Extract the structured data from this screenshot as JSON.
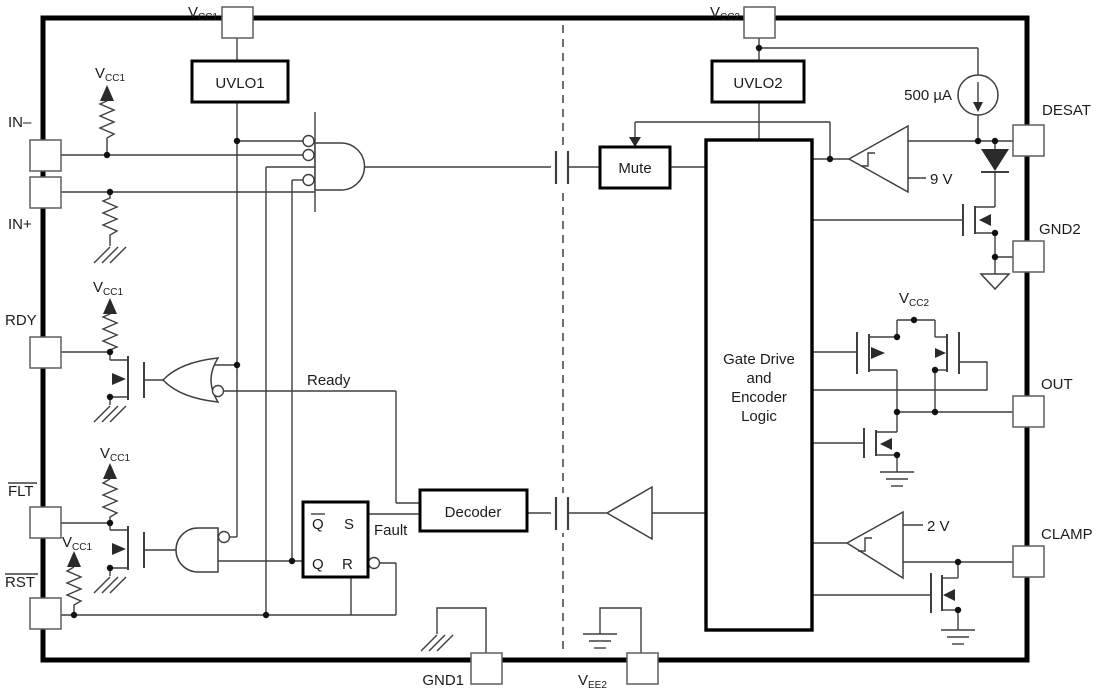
{
  "diagram": {
    "pins": {
      "vcc1": {
        "base": "V",
        "sub": "CC1"
      },
      "vcc2": {
        "base": "V",
        "sub": "CC2"
      },
      "vee2": {
        "base": "V",
        "sub": "EE2"
      },
      "in_minus": "IN–",
      "in_plus": "IN+",
      "rdy": "RDY",
      "flt": "FLT",
      "rst": "RST",
      "desat": "DESAT",
      "gnd2": "GND2",
      "out": "OUT",
      "clamp": "CLAMP",
      "gnd1": "GND1"
    },
    "blocks": {
      "uvlo1": "UVLO1",
      "uvlo2": "UVLO2",
      "mute": "Mute",
      "decoder": "Decoder",
      "gate_drive": [
        "Gate Drive",
        "and",
        "Encoder",
        "Logic"
      ]
    },
    "latch": {
      "q_bar": "Q",
      "s": "S",
      "q": "Q",
      "r": "R"
    },
    "signals": {
      "ready": "Ready",
      "fault": "Fault"
    },
    "values": {
      "desat_current": "500 µA",
      "desat_threshold": "9 V",
      "clamp_threshold": "2 V"
    },
    "colors": {
      "signal_label": "#A3383F",
      "wire": "#3F3F3F",
      "block_border": "#000000"
    }
  }
}
